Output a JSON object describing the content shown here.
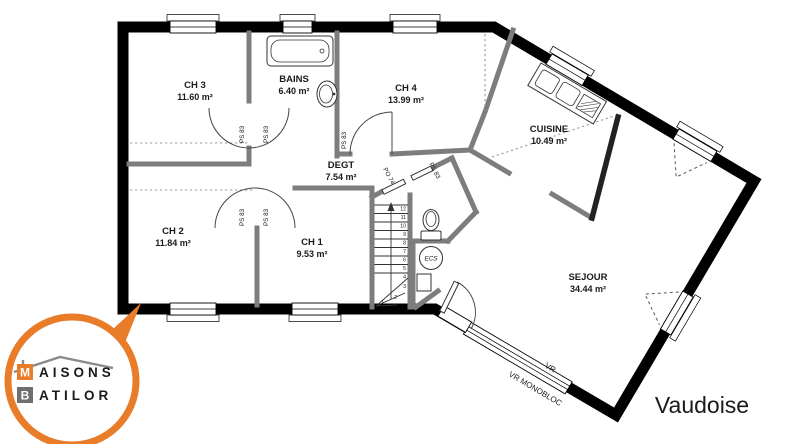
{
  "model_name": "Vaudoise",
  "brand": {
    "m": "M",
    "maisons_rest": "AISONS",
    "b": "B",
    "batilor_rest": "ATILOR"
  },
  "rooms": [
    {
      "name": "CH 3",
      "area": "11.60 m²"
    },
    {
      "name": "BAINS",
      "area": "6.40 m²"
    },
    {
      "name": "CH 4",
      "area": "13.99 m²"
    },
    {
      "name": "CUISINE",
      "area": "10.49 m²"
    },
    {
      "name": "DEGT",
      "area": "7.54 m²"
    },
    {
      "name": "CH 2",
      "area": "11.84 m²"
    },
    {
      "name": "CH 1",
      "area": "9.53 m²"
    },
    {
      "name": "SEJOUR",
      "area": "34.44 m²"
    }
  ],
  "door_labels": [
    "PS 83",
    "PS 83",
    "PS 83",
    "PS 83",
    "PS 83",
    "PS 83",
    "PO 74"
  ],
  "stairs": {
    "steps": [
      "12",
      "11",
      "10",
      "9",
      "8",
      "7",
      "6",
      "5",
      "4",
      "3",
      "2",
      "1"
    ]
  },
  "equipment": {
    "water_heater": "ECS"
  },
  "window_labels": {
    "vr": "VR",
    "vr_monobloc": "VR MONOBLOC"
  },
  "colors": {
    "accent_orange": "#e87c28",
    "brand_gray": "#6f6f6f",
    "model_red": "#e8402e"
  }
}
